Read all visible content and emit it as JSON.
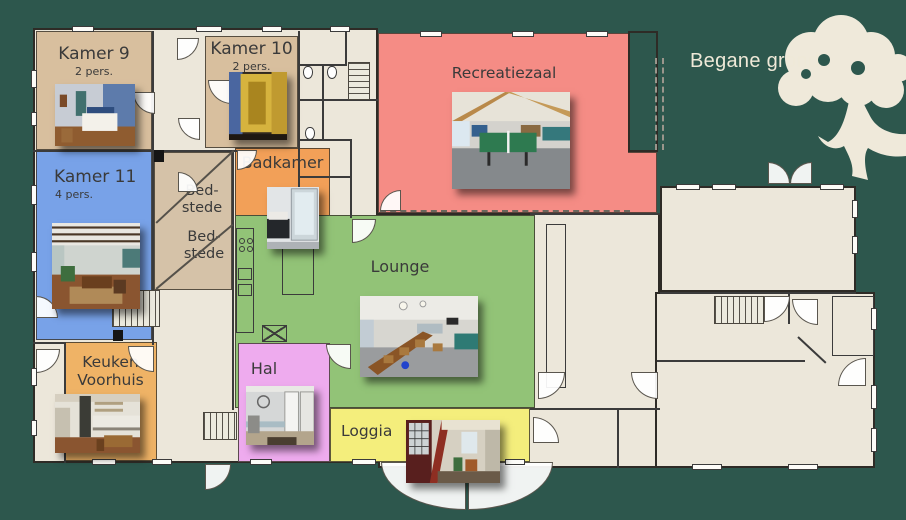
{
  "title": "Begane grond",
  "background_color": "#2d574d",
  "plan": {
    "floor_color": "#ece7da",
    "wall_color": "#3b3b3b",
    "rooms": {
      "kamer9": {
        "name": "Kamer 9",
        "capacity": "2 pers.",
        "color": "#d8bf9e",
        "photo": "bedroom-photo"
      },
      "kamer10": {
        "name": "Kamer 10",
        "capacity": "2 pers.",
        "color": "#d8bf9e",
        "photo": "wardrobe-photo"
      },
      "kamer11": {
        "name": "Kamer 11",
        "capacity": "4 pers.",
        "color": "#78a2e8",
        "photo": "living-room-photo"
      },
      "badkamer": {
        "name": "Badkamer",
        "color": "#f2a058",
        "photo": "shower-photo"
      },
      "bedstede_top": {
        "line1": "Bed-",
        "line2": "stede",
        "color": "#d5c2a8"
      },
      "bedstede_bottom": {
        "line1": "Bed-",
        "line2": "stede",
        "color": "#d5c2a8"
      },
      "recreatiezaal": {
        "name": "Recreatiezaal",
        "color": "#f58c85",
        "photo": "recreation-room-photo"
      },
      "lounge": {
        "name": "Lounge",
        "color": "#92c377",
        "photo": "dining-room-photo"
      },
      "hal": {
        "name": "Hal",
        "color": "#eeabee",
        "photo": "hallway-photo"
      },
      "keuken": {
        "line1": "Keuken",
        "line2": "Voorhuis",
        "color": "#efb366",
        "photo": "kitchen-photo"
      },
      "loggia": {
        "name": "Loggia",
        "color": "#f4ee7c",
        "photo": "loggia-photo"
      }
    }
  }
}
